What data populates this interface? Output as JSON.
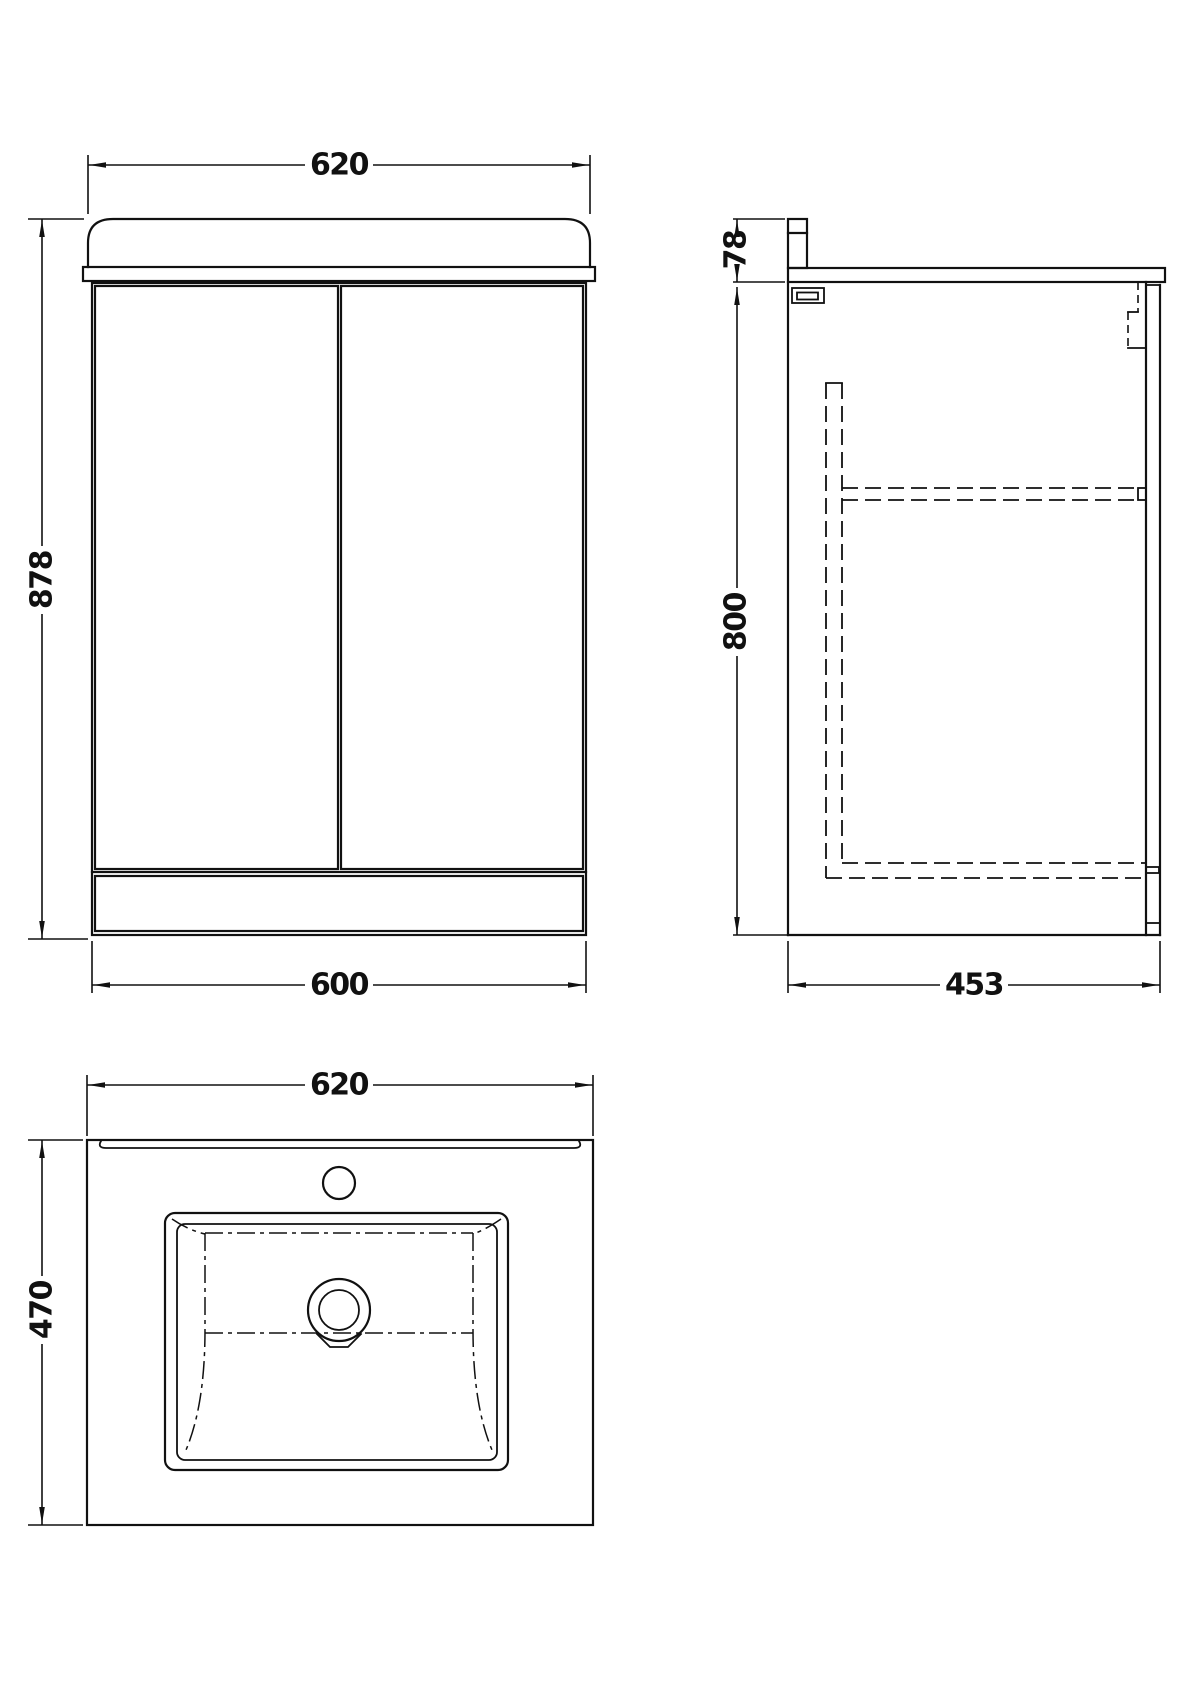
{
  "colors": {
    "line": "#111111",
    "background": "#ffffff"
  },
  "views": {
    "front": {
      "dim_width_top": "620",
      "dim_height": "878",
      "dim_width_bottom": "600"
    },
    "side": {
      "dim_basin_height": "78",
      "dim_cabinet_height": "800",
      "dim_depth": "453"
    },
    "plan": {
      "dim_width": "620",
      "dim_depth": "470"
    }
  }
}
